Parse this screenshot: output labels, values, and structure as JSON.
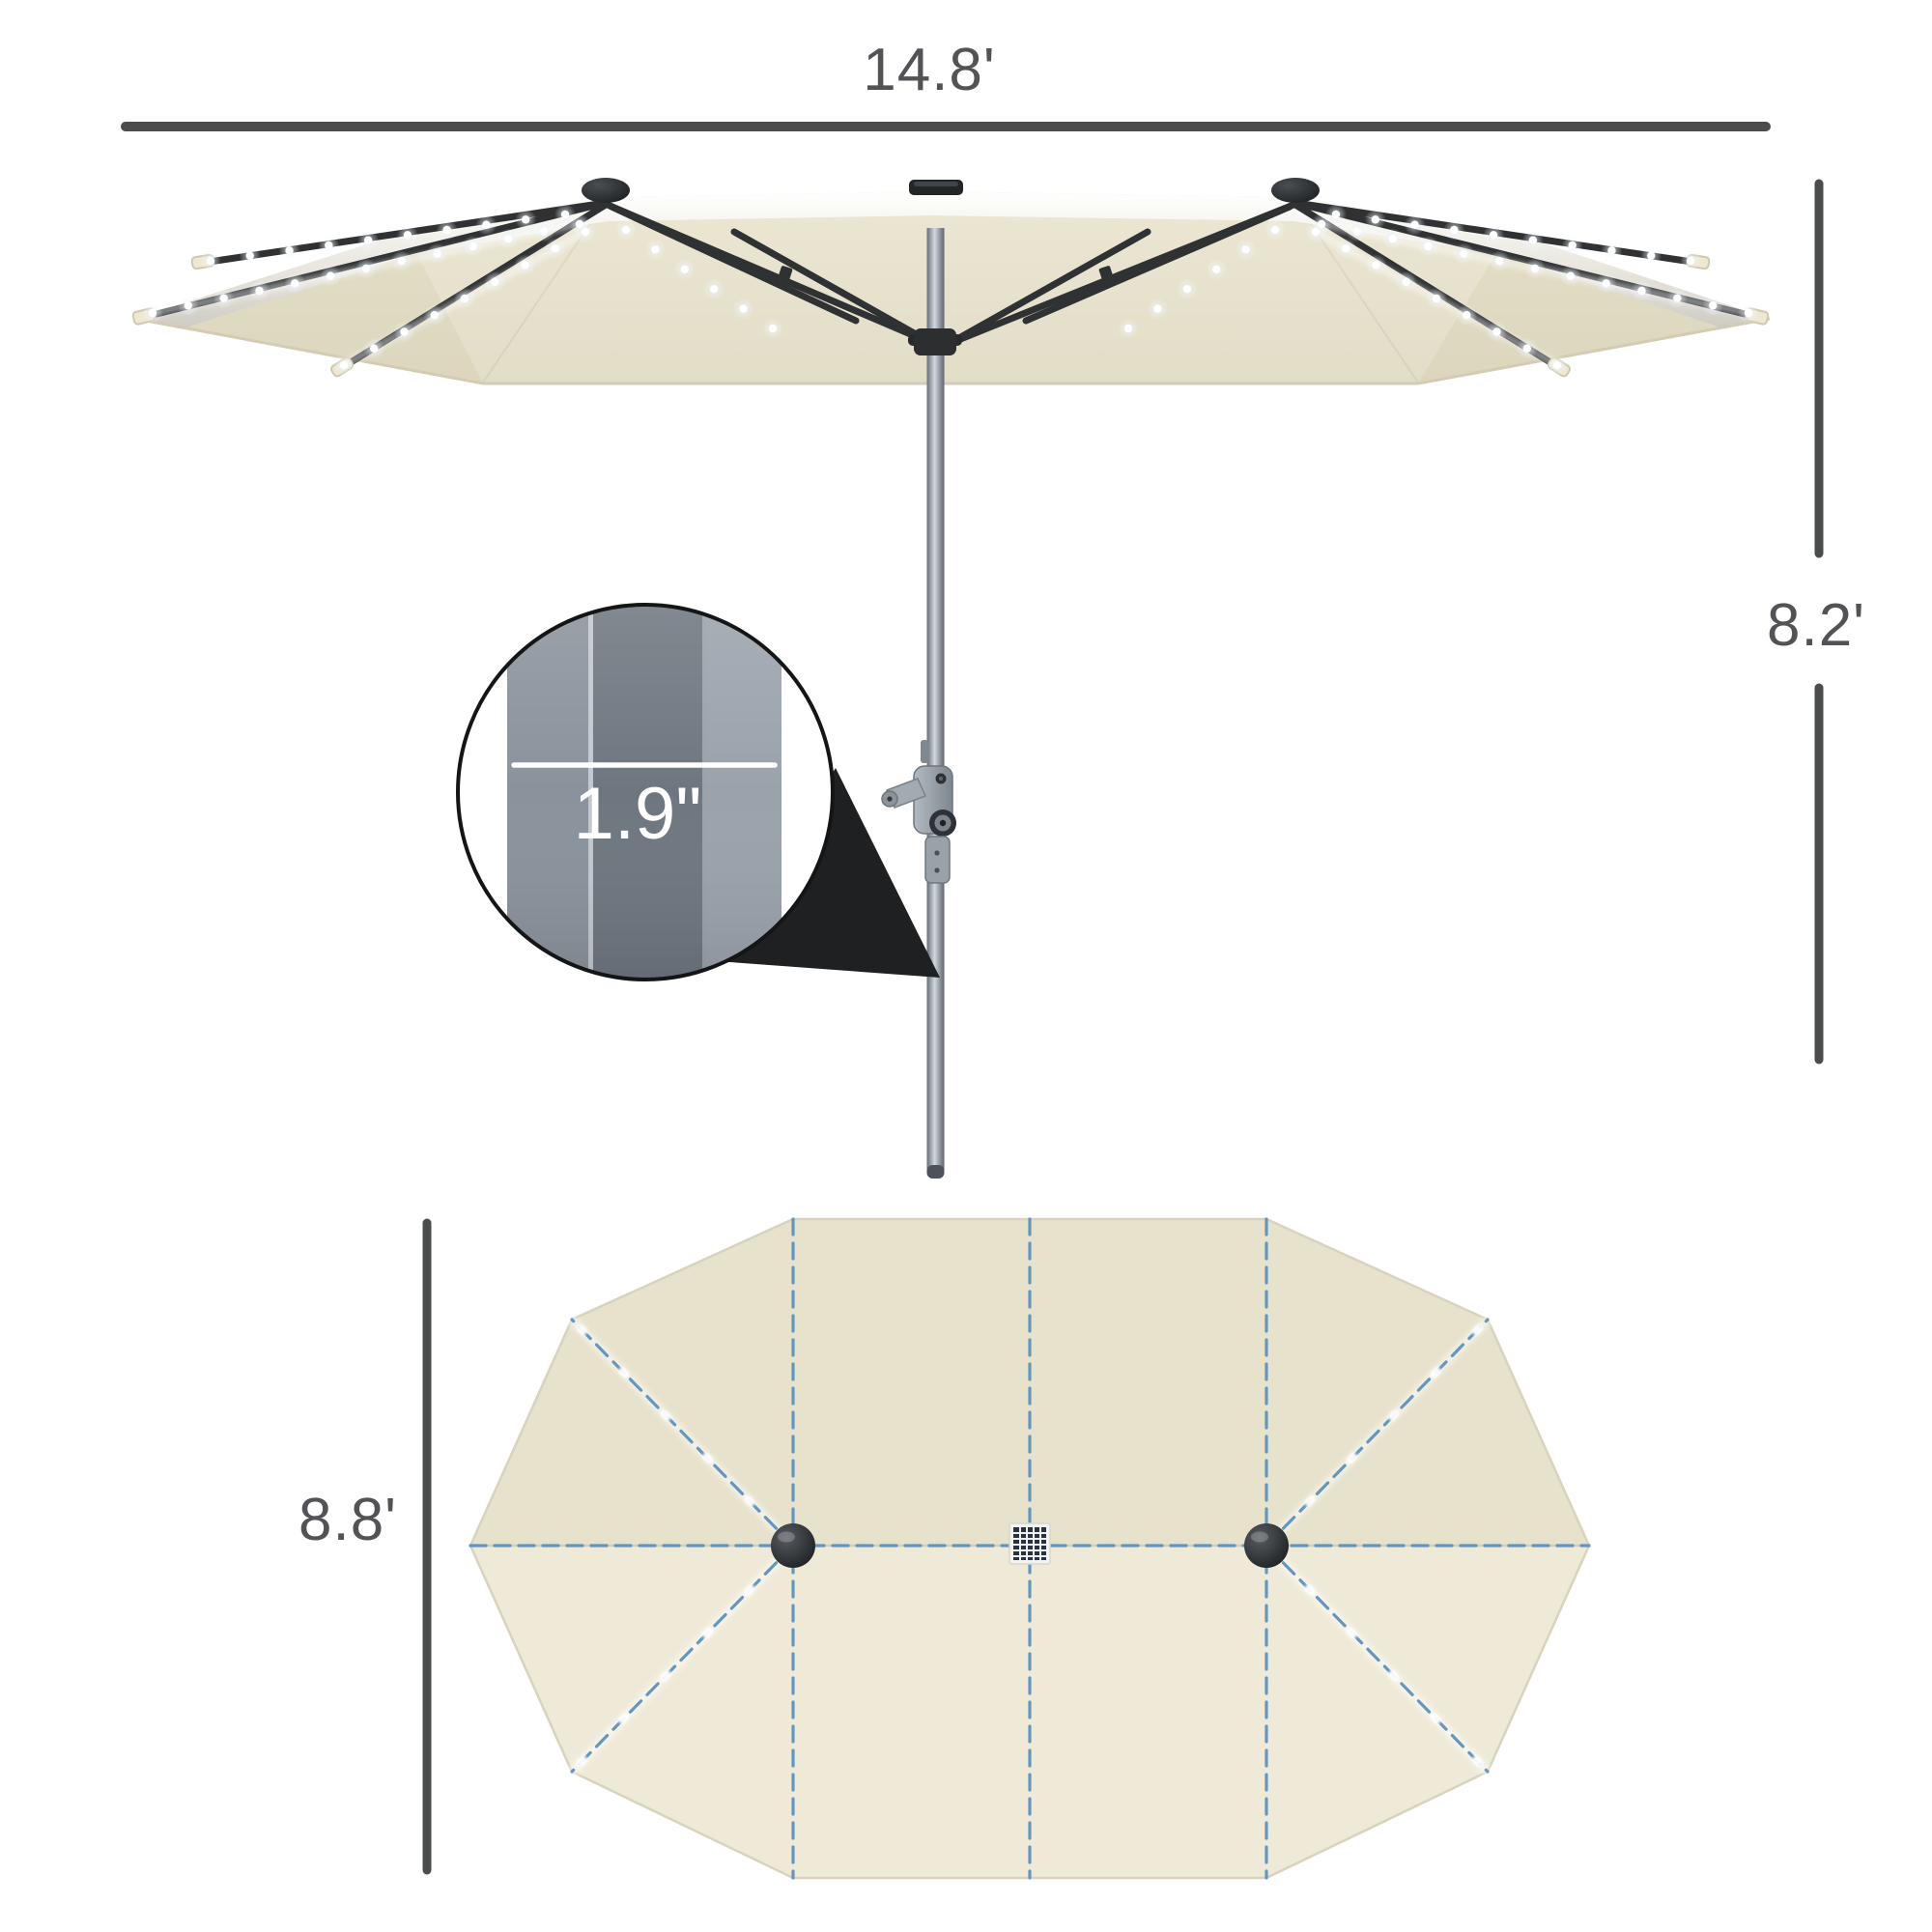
{
  "dimensions": {
    "canopy_width": "14.8'",
    "umbrella_height": "8.2'",
    "pole_diameter": "1.9\"",
    "canopy_depth": "8.8'"
  },
  "colors": {
    "canopy": "#e9e4d0",
    "canopy_top_upper": "#e7e2cc",
    "canopy_top_lower": "#efead8",
    "dimension_line": "#4a4c4e",
    "label_text": "#515356",
    "led_blue": "#5d93bd",
    "frame_black": "#2f3133",
    "wedge_black": "#1e2022",
    "callout_text": "#ffffff"
  }
}
